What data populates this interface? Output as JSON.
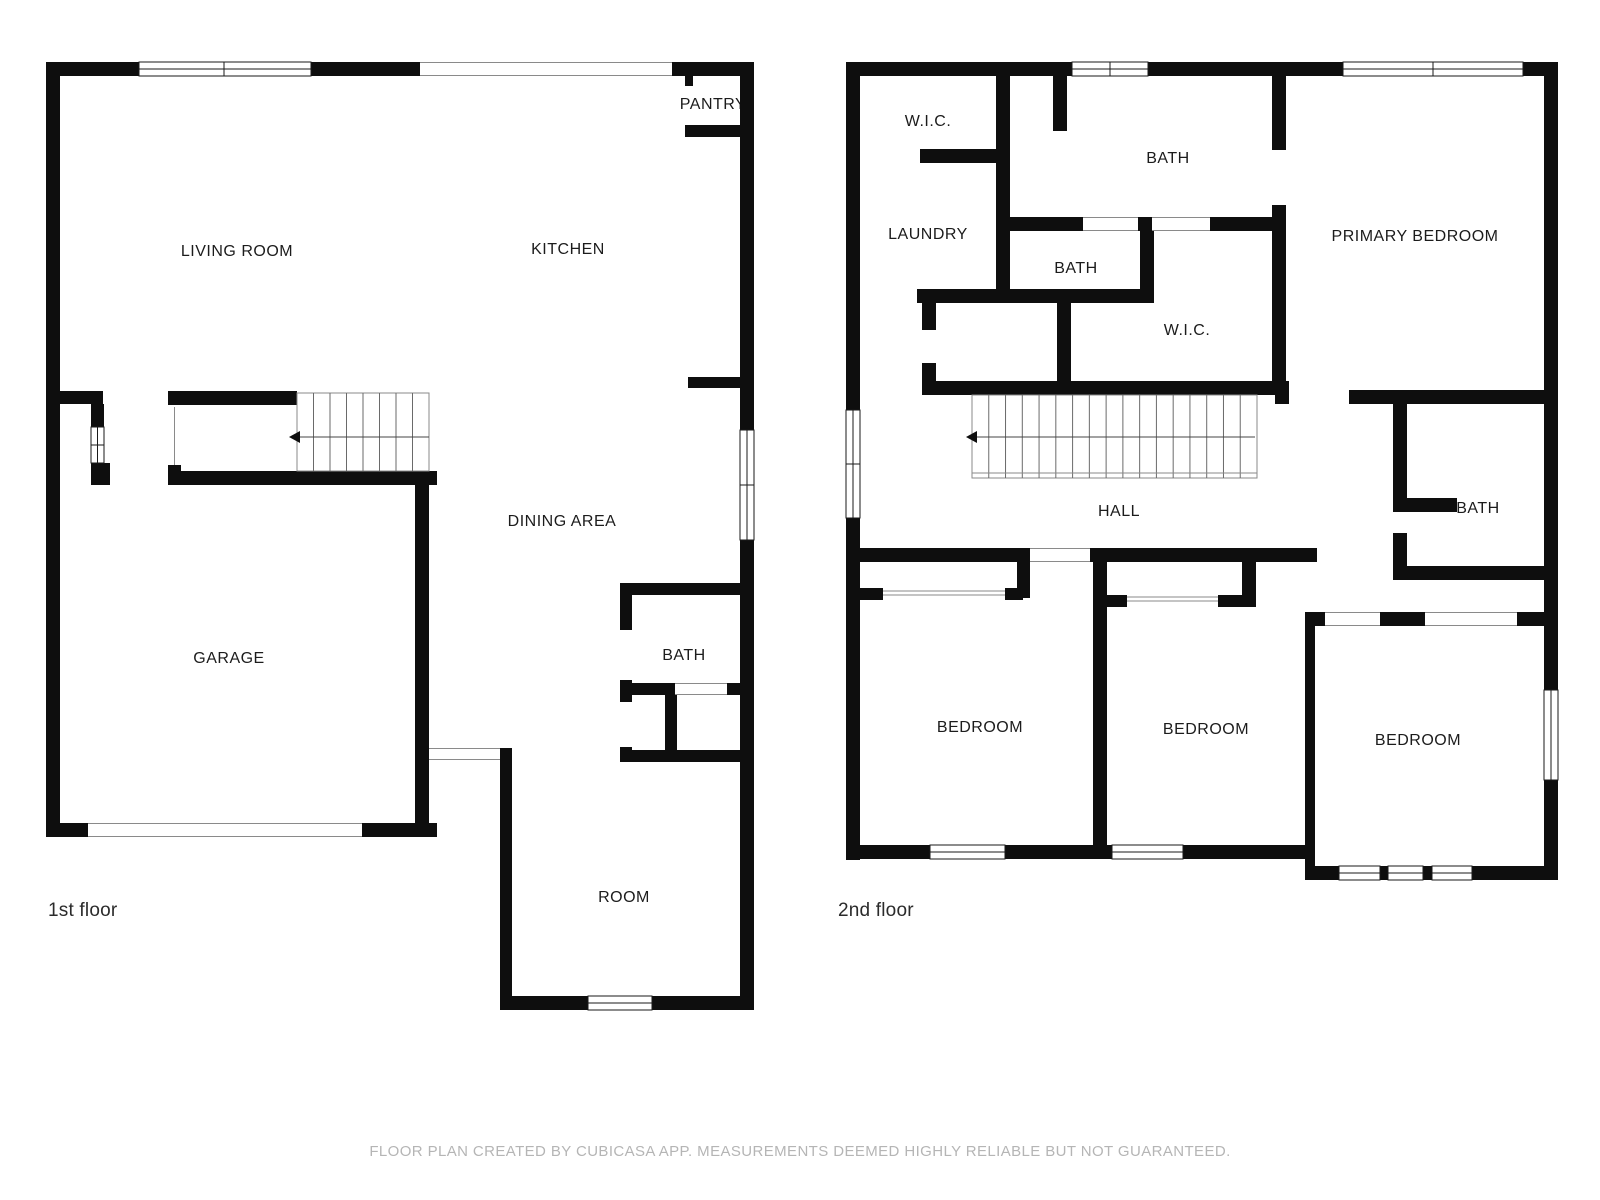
{
  "colors": {
    "wall": "#0e0e0e",
    "window_frame": "#1a1a1a",
    "opening_line": "#8a8a8a",
    "stair_line": "#6a6a6a",
    "stair_outline": "#8a8a8a",
    "arrow": "#444444",
    "label": "#1c1c1c",
    "floor_label": "#2b2b2b",
    "footer": "#b5b5b5"
  },
  "footer": {
    "text": "FLOOR PLAN CREATED BY CUBICASA APP. MEASUREMENTS DEEMED HIGHLY RELIABLE BUT NOT GUARANTEED."
  },
  "floors": [
    {
      "floor_label": {
        "text": "1st floor",
        "x": 48,
        "y": 916
      },
      "room_labels": [
        {
          "text": "LIVING ROOM",
          "x": 237,
          "y": 256
        },
        {
          "text": "KITCHEN",
          "x": 568,
          "y": 254
        },
        {
          "text": "PANTRY",
          "x": 713,
          "y": 109
        },
        {
          "text": "DINING AREA",
          "x": 562,
          "y": 526
        },
        {
          "text": "GARAGE",
          "x": 229,
          "y": 663
        },
        {
          "text": "BATH",
          "x": 684,
          "y": 660
        },
        {
          "text": "ROOM",
          "x": 624,
          "y": 902
        }
      ],
      "walls": [
        [
          46,
          62,
          708,
          14
        ],
        [
          46,
          62,
          14,
          775
        ],
        [
          740,
          62,
          14,
          948
        ],
        [
          46,
          823,
          391,
          14
        ],
        [
          500,
          996,
          254,
          14
        ],
        [
          685,
          76,
          8,
          10
        ],
        [
          685,
          125,
          58,
          12
        ],
        [
          688,
          377,
          52,
          11
        ],
        [
          168,
          391,
          129,
          14
        ],
        [
          168,
          465,
          13,
          20
        ],
        [
          168,
          471,
          269,
          14
        ],
        [
          60,
          391,
          43,
          13
        ],
        [
          91,
          404,
          13,
          23
        ],
        [
          91,
          463,
          19,
          22
        ],
        [
          415,
          471,
          14,
          366
        ],
        [
          500,
          748,
          12,
          262
        ],
        [
          620,
          583,
          120,
          12
        ],
        [
          620,
          583,
          12,
          47
        ],
        [
          620,
          680,
          12,
          22
        ],
        [
          620,
          747,
          12,
          15
        ],
        [
          620,
          683,
          55,
          12
        ],
        [
          727,
          683,
          13,
          12
        ],
        [
          665,
          695,
          12,
          67
        ],
        [
          620,
          750,
          134,
          12
        ]
      ],
      "windows": [
        {
          "x": 139,
          "y": 62,
          "w": 172,
          "h": 14,
          "mullions": [
            224
          ]
        },
        {
          "x": 740,
          "y": 430,
          "w": 14,
          "h": 110,
          "mullions": [
            485
          ]
        },
        {
          "x": 91,
          "y": 427,
          "w": 13,
          "h": 36,
          "mullions": [
            445
          ]
        },
        {
          "x": 588,
          "y": 996,
          "w": 64,
          "h": 14,
          "mullions": []
        }
      ],
      "openings": [
        {
          "x": 420,
          "y": 62,
          "w": 252,
          "h": 14
        },
        {
          "x": 88,
          "y": 823,
          "w": 274,
          "h": 14
        },
        {
          "x": 429,
          "y": 748,
          "w": 71,
          "h": 12
        },
        {
          "x": 675,
          "y": 683,
          "w": 52,
          "h": 12
        }
      ],
      "door_lines": [
        [
          174.5,
          407,
          174.5,
          465
        ]
      ],
      "stairs": [
        {
          "x": 297,
          "y": 393,
          "w": 132,
          "h": 78,
          "treads": 7,
          "arrow": {
            "y": 437,
            "from": 429,
            "to": 297,
            "head": 289
          }
        }
      ]
    },
    {
      "floor_label": {
        "text": "2nd floor",
        "x": 838,
        "y": 916
      },
      "room_labels": [
        {
          "text": "W.I.C.",
          "x": 928,
          "y": 126
        },
        {
          "text": "BATH",
          "x": 1168,
          "y": 163
        },
        {
          "text": "LAUNDRY",
          "x": 928,
          "y": 239
        },
        {
          "text": "BATH",
          "x": 1076,
          "y": 273
        },
        {
          "text": "W.I.C.",
          "x": 1187,
          "y": 335
        },
        {
          "text": "PRIMARY BEDROOM",
          "x": 1415,
          "y": 241
        },
        {
          "text": "HALL",
          "x": 1119,
          "y": 516
        },
        {
          "text": "BATH",
          "x": 1478,
          "y": 513
        },
        {
          "text": "BEDROOM",
          "x": 980,
          "y": 732
        },
        {
          "text": "BEDROOM",
          "x": 1206,
          "y": 734
        },
        {
          "text": "BEDROOM",
          "x": 1418,
          "y": 745
        }
      ],
      "walls": [
        [
          846,
          62,
          712,
          14
        ],
        [
          846,
          62,
          14,
          798
        ],
        [
          1544,
          62,
          14,
          818
        ],
        [
          846,
          845,
          469,
          14
        ],
        [
          1305,
          866,
          253,
          14
        ],
        [
          1305,
          845,
          10,
          35
        ],
        [
          996,
          76,
          14,
          227
        ],
        [
          920,
          149,
          90,
          14
        ],
        [
          917,
          289,
          237,
          14
        ],
        [
          922,
          303,
          14,
          27
        ],
        [
          922,
          363,
          14,
          32
        ],
        [
          923,
          381,
          366,
          14
        ],
        [
          1349,
          390,
          195,
          14
        ],
        [
          1275,
          381,
          14,
          23
        ],
        [
          1053,
          76,
          14,
          55
        ],
        [
          1010,
          217,
          73,
          14
        ],
        [
          1138,
          217,
          14,
          14
        ],
        [
          1210,
          217,
          76,
          14
        ],
        [
          1272,
          76,
          14,
          74
        ],
        [
          1272,
          205,
          14,
          190
        ],
        [
          1140,
          231,
          14,
          72
        ],
        [
          1057,
          303,
          14,
          92
        ],
        [
          846,
          548,
          184,
          14
        ],
        [
          1090,
          548,
          227,
          14
        ],
        [
          1017,
          562,
          13,
          36
        ],
        [
          860,
          588,
          23,
          12
        ],
        [
          1005,
          588,
          18,
          12
        ],
        [
          1093,
          550,
          14,
          309
        ],
        [
          1102,
          595,
          25,
          12
        ],
        [
          1218,
          595,
          27,
          12
        ],
        [
          1242,
          562,
          14,
          45
        ],
        [
          1305,
          612,
          10,
          233
        ],
        [
          1307,
          612,
          18,
          14
        ],
        [
          1380,
          612,
          45,
          14
        ],
        [
          1517,
          612,
          27,
          14
        ],
        [
          1393,
          404,
          14,
          94
        ],
        [
          1393,
          498,
          64,
          14
        ],
        [
          1393,
          533,
          14,
          47
        ],
        [
          1393,
          566,
          151,
          14
        ]
      ],
      "windows": [
        {
          "x": 1072,
          "y": 62,
          "w": 76,
          "h": 14,
          "mullions": [
            1110
          ]
        },
        {
          "x": 1343,
          "y": 62,
          "w": 180,
          "h": 14,
          "mullions": [
            1433
          ]
        },
        {
          "x": 846,
          "y": 410,
          "w": 14,
          "h": 108,
          "mullions": [
            464
          ]
        },
        {
          "x": 1544,
          "y": 690,
          "w": 14,
          "h": 90,
          "mullions": []
        },
        {
          "x": 930,
          "y": 845,
          "w": 75,
          "h": 14,
          "mullions": []
        },
        {
          "x": 1112,
          "y": 845,
          "w": 71,
          "h": 14,
          "mullions": []
        },
        {
          "x": 1339,
          "y": 866,
          "w": 41,
          "h": 14,
          "mullions": []
        },
        {
          "x": 1388,
          "y": 866,
          "w": 35,
          "h": 14,
          "mullions": []
        },
        {
          "x": 1432,
          "y": 866,
          "w": 40,
          "h": 14,
          "mullions": []
        }
      ],
      "openings": [
        {
          "x": 1030,
          "y": 548,
          "w": 60,
          "h": 14
        },
        {
          "x": 1083,
          "y": 217,
          "w": 55,
          "h": 14
        },
        {
          "x": 1152,
          "y": 217,
          "w": 58,
          "h": 14
        },
        {
          "x": 1325,
          "y": 612,
          "w": 55,
          "h": 14
        },
        {
          "x": 1425,
          "y": 612,
          "w": 92,
          "h": 14
        }
      ],
      "door_lines": [
        [
          883,
          591,
          1005,
          591
        ],
        [
          883,
          595,
          1005,
          595
        ],
        [
          1127,
          597,
          1218,
          597
        ],
        [
          1127,
          601,
          1218,
          601
        ]
      ],
      "stairs": [
        {
          "x": 972,
          "y": 395,
          "w": 285,
          "h": 83,
          "treads": 16,
          "extra_bottom_line": 473,
          "arrow": {
            "y": 437,
            "from": 1255,
            "to": 974,
            "head": 966
          }
        }
      ]
    }
  ]
}
